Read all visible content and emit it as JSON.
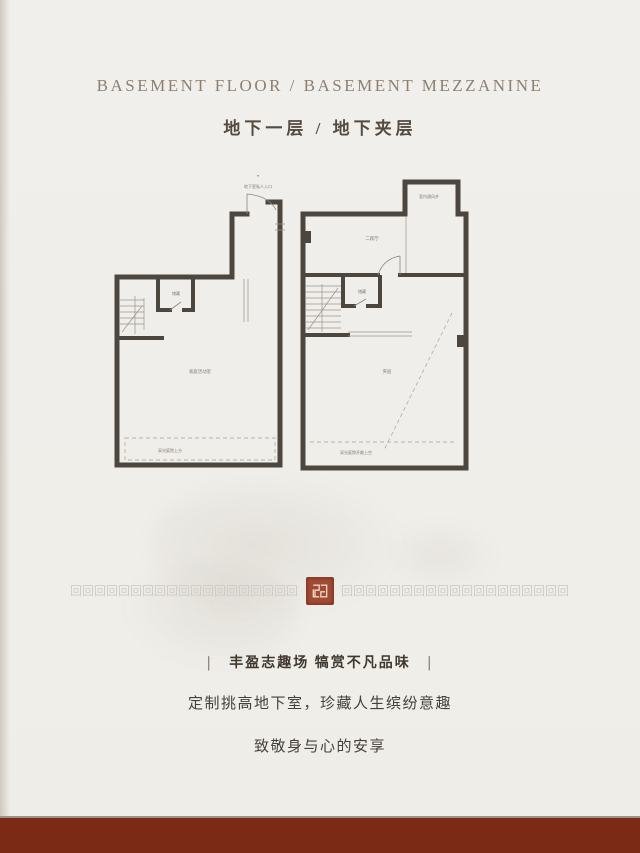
{
  "header": {
    "title_en": "BASEMENT FLOOR / BASEMENT MEZZANINE",
    "title_cn": "地下一层 / 地下夹层"
  },
  "plans": {
    "left": {
      "entrance_marker": "▾",
      "entrance_label": "地下室私人入口",
      "storage_label": "储藏",
      "activity_label": "家庭活动室",
      "courtyard_label": "采光庭院上方"
    },
    "right": {
      "vent_label": "室内通风井",
      "hall_label": "二跃厅",
      "storage_label": "储藏",
      "mezzanine_label": "夹层",
      "courtyard_label": "采光庭院开敞上空"
    }
  },
  "divider": {
    "pattern_char": "回",
    "repeat": 40
  },
  "tagline": {
    "bar": "丨",
    "line1": "丰盈志趣场 犒赏不凡品味",
    "line2": "定制挑高地下室，珍藏人生缤纷意趣",
    "line3": "致敬身与心的安享"
  },
  "colors": {
    "paper": "#f0eeea",
    "wall": "#4c463f",
    "title_gold": "#8d8072",
    "title_dark": "#564b41",
    "seal_red": "#a24a34",
    "footer_red": "#7b2a16"
  }
}
